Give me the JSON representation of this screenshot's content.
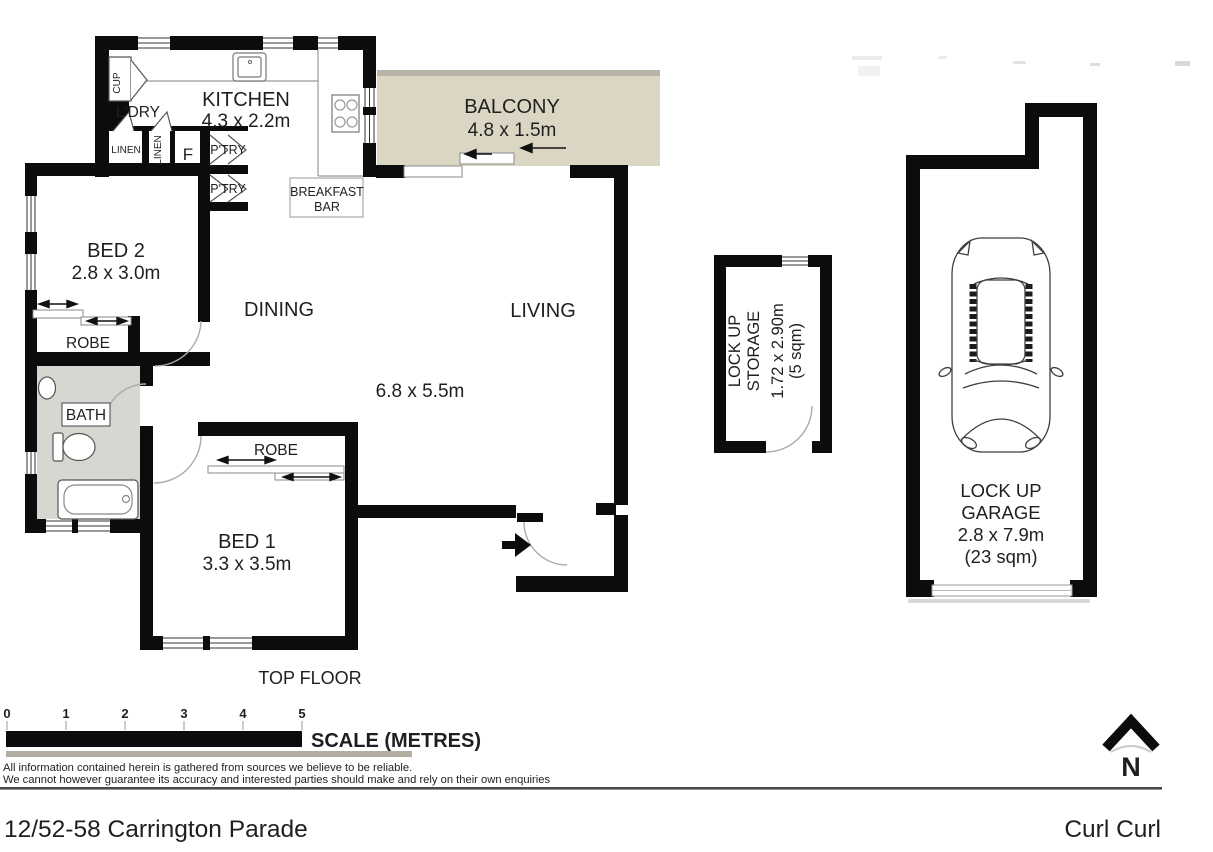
{
  "page": {
    "address": "12/52-58 Carrington Parade",
    "suburb": "Curl Curl"
  },
  "plan": {
    "floor_label": "TOP FLOOR",
    "rooms": {
      "kitchen": {
        "name": "KITCHEN",
        "dims": "4.3 x 2.2m"
      },
      "balcony": {
        "name": "BALCONY",
        "dims": "4.8 x 1.5m"
      },
      "laundry": {
        "name": "L'DRY"
      },
      "bed2": {
        "name": "BED 2",
        "dims": "2.8 x 3.0m"
      },
      "bed1": {
        "name": "BED 1",
        "dims": "3.3 x 3.5m"
      },
      "dining": {
        "name": "DINING"
      },
      "living": {
        "name": "LIVING"
      },
      "living_dining_dims": "6.8 x 5.5m",
      "bath": {
        "name": "BATH"
      },
      "robe_bed2": "ROBE",
      "robe_bed1": "ROBE",
      "breakfast_bar": {
        "line1": "BREAKFAST",
        "line2": "BAR"
      }
    },
    "closets": {
      "cup": "CUP",
      "linen_a": "LINEN",
      "linen_b": "LINEN",
      "fridge": "F",
      "pantry_a": "P'TRY",
      "pantry_b": "P'TRY"
    }
  },
  "storage": {
    "name_line1": "LOCK UP",
    "name_line2": "STORAGE",
    "dims": "1.72 x 2.90m",
    "area": "(5 sqm)"
  },
  "garage": {
    "name_line1": "LOCK UP",
    "name_line2": "GARAGE",
    "dims": "2.8 x 7.9m",
    "area": "(23 sqm)"
  },
  "scale_bar": {
    "numbers": [
      "0",
      "1",
      "2",
      "3",
      "4",
      "5"
    ],
    "label": "SCALE (METRES)"
  },
  "disclaimer": {
    "line1": "All information contained herein is gathered from sources we believe to be reliable.",
    "line2": "We cannot however guarantee its accuracy and interested parties should make and rely on their own enquiries"
  },
  "compass": {
    "north_label": "N"
  },
  "colors": {
    "wall": "#0c0c0c",
    "balcony_fill": "#dbd6c4",
    "balcony_band": "#b7b3a7",
    "bath_fill": "#d8d6d1",
    "scale_underline": "#b2aea2",
    "rule": "#4a4a4a"
  }
}
